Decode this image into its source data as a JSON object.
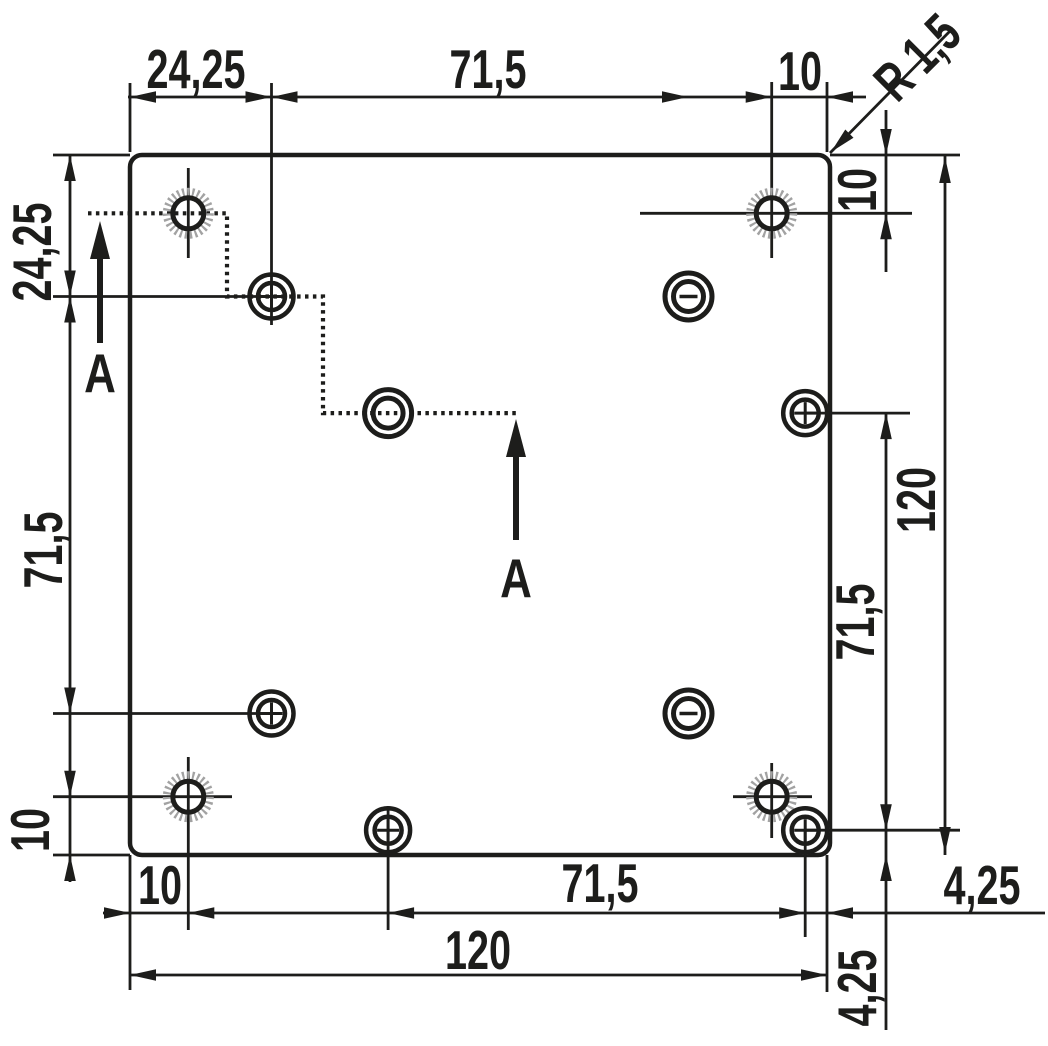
{
  "drawing": {
    "canvas": {
      "width": 1048,
      "height": 1046,
      "background": "#ffffff"
    },
    "colors": {
      "line": "#1d1d1b",
      "hatch": "#a2a2a2",
      "plate_fill": "#ffffff"
    },
    "plate": {
      "x": 130,
      "y": 155,
      "width": 700,
      "height": 700,
      "corner_radius": 12,
      "stroke_width": 4.5
    },
    "dimension_labels": [
      {
        "name": "dim-top-24-25",
        "text": "24,25",
        "x": 196,
        "y": 70,
        "rotate": 0
      },
      {
        "name": "dim-top-71-5",
        "text": "71,5",
        "x": 488,
        "y": 70,
        "rotate": 0
      },
      {
        "name": "dim-top-10",
        "text": "10",
        "x": 800,
        "y": 72,
        "rotate": 0
      },
      {
        "name": "dim-corner-radius",
        "text": "R 1,5",
        "x": 918,
        "y": 58,
        "rotate": -45
      },
      {
        "name": "dim-right-10",
        "text": "10",
        "x": 858,
        "y": 190,
        "rotate": -90
      },
      {
        "name": "dim-right-120",
        "text": "120",
        "x": 917,
        "y": 500,
        "rotate": -90
      },
      {
        "name": "dim-right-71-5",
        "text": "71,5",
        "x": 856,
        "y": 622,
        "rotate": -90
      },
      {
        "name": "dim-right-4-25",
        "text": "4,25",
        "x": 982,
        "y": 886,
        "rotate": 0
      },
      {
        "name": "dim-bottom-right-4-25",
        "text": "4,25",
        "x": 858,
        "y": 988,
        "rotate": -90
      },
      {
        "name": "dim-bottom-10",
        "text": "10",
        "x": 160,
        "y": 886,
        "rotate": 0
      },
      {
        "name": "dim-bottom-71-5",
        "text": "71,5",
        "x": 600,
        "y": 884,
        "rotate": 0
      },
      {
        "name": "dim-bottom-120",
        "text": "120",
        "x": 478,
        "y": 951,
        "rotate": 0
      },
      {
        "name": "dim-left-10",
        "text": "10",
        "x": 31,
        "y": 830,
        "rotate": -90
      },
      {
        "name": "dim-left-71-5",
        "text": "71,5",
        "x": 44,
        "y": 550,
        "rotate": -90
      },
      {
        "name": "dim-left-24-25",
        "text": "24,25",
        "x": 33,
        "y": 252,
        "rotate": -90
      },
      {
        "name": "section-label-a-left",
        "text": "A",
        "x": 100,
        "y": 373,
        "rotate": 0,
        "size": 55,
        "sx": 0.8
      },
      {
        "name": "section-label-a-right",
        "text": "A",
        "x": 516,
        "y": 578,
        "rotate": 0,
        "size": 55,
        "sx": 0.8
      }
    ],
    "holes": [
      {
        "type": "hatched",
        "x": 188.3,
        "y": 213.3
      },
      {
        "type": "hatched",
        "x": 771.7,
        "y": 213.3
      },
      {
        "type": "hatched",
        "x": 188.3,
        "y": 796.7
      },
      {
        "type": "hatched",
        "x": 771.7,
        "y": 796.7
      },
      {
        "type": "plus",
        "x": 271.5,
        "y": 296.5
      },
      {
        "type": "plus",
        "x": 271.5,
        "y": 713.5
      },
      {
        "type": "plus",
        "x": 805.2,
        "y": 413.1
      },
      {
        "type": "plus",
        "x": 388.1,
        "y": 830.2
      },
      {
        "type": "plus",
        "x": 805.2,
        "y": 830.2
      },
      {
        "type": "minus",
        "x": 688.5,
        "y": 296.5
      },
      {
        "type": "minus",
        "x": 688.5,
        "y": 713.5
      },
      {
        "type": "plain",
        "x": 388.1,
        "y": 413.1
      }
    ],
    "thin_lines": [
      [
        130,
        83,
        130,
        152
      ],
      [
        271.5,
        83,
        271.5,
        325
      ],
      [
        771.7,
        82,
        771.7,
        258
      ],
      [
        827,
        82,
        827,
        152
      ],
      [
        128,
        97,
        866,
        97
      ],
      [
        53,
        155,
        130,
        155
      ],
      [
        53,
        296.5,
        272,
        296.5
      ],
      [
        53,
        713.5,
        272,
        713.5
      ],
      [
        53,
        796.7,
        232,
        796.7
      ],
      [
        53,
        855,
        130,
        855
      ],
      [
        70,
        155,
        70,
        882
      ],
      [
        130,
        855,
        130,
        990
      ],
      [
        188.3,
        757,
        188.3,
        930
      ],
      [
        388.1,
        806,
        388.1,
        930
      ],
      [
        805.2,
        830,
        805.2,
        937
      ],
      [
        827,
        855,
        827,
        992
      ],
      [
        103,
        913,
        1045,
        913
      ],
      [
        130,
        975,
        827,
        975
      ],
      [
        830,
        155,
        960,
        155
      ],
      [
        640,
        213.3,
        912,
        213.3
      ],
      [
        805,
        413.1,
        910,
        413.1
      ],
      [
        805,
        830.2,
        960,
        830.2
      ],
      [
        886,
        110,
        886,
        272
      ],
      [
        886,
        413,
        886,
        1030
      ],
      [
        945,
        155,
        945,
        855
      ],
      [
        830,
        153,
        953,
        28
      ],
      [
        188.3,
        168,
        188.3,
        258
      ],
      [
        771.7,
        763,
        771.7,
        838
      ],
      [
        733,
        796.7,
        812,
        796.7
      ]
    ],
    "arrowheads": [
      [
        130,
        97,
        "left"
      ],
      [
        271.5,
        97,
        "right"
      ],
      [
        271.5,
        97,
        "left"
      ],
      [
        688,
        97,
        "right"
      ],
      [
        771.7,
        97,
        "right"
      ],
      [
        827,
        97,
        "left"
      ],
      [
        70,
        155,
        "up"
      ],
      [
        70,
        296.5,
        "down"
      ],
      [
        70,
        296.5,
        "up"
      ],
      [
        70,
        713.5,
        "down"
      ],
      [
        70,
        796.7,
        "down"
      ],
      [
        70,
        855,
        "up"
      ],
      [
        130,
        913,
        "right"
      ],
      [
        188.3,
        913,
        "left"
      ],
      [
        388.1,
        913,
        "left"
      ],
      [
        805.2,
        913,
        "right"
      ],
      [
        827,
        913,
        "left"
      ],
      [
        130,
        975,
        "left"
      ],
      [
        827,
        975,
        "right"
      ],
      [
        886,
        155,
        "down"
      ],
      [
        886,
        213.3,
        "up"
      ],
      [
        886,
        413.1,
        "up"
      ],
      [
        886,
        830.2,
        "down"
      ],
      [
        886,
        855,
        "up"
      ],
      [
        945,
        157,
        "up"
      ],
      [
        945,
        853,
        "down"
      ],
      [
        831,
        152,
        135
      ]
    ],
    "section_line": {
      "points": [
        [
          88,
          213.3
        ],
        [
          227,
          213.3
        ],
        [
          227,
          296.5
        ],
        [
          323,
          296.5
        ],
        [
          323,
          413.1
        ],
        [
          517,
          413.1
        ]
      ]
    },
    "section_arrows": [
      {
        "tip_x": 100,
        "tip_y": 221,
        "tail_y": 343
      },
      {
        "tip_x": 516,
        "tip_y": 419,
        "tail_y": 540
      }
    ]
  }
}
